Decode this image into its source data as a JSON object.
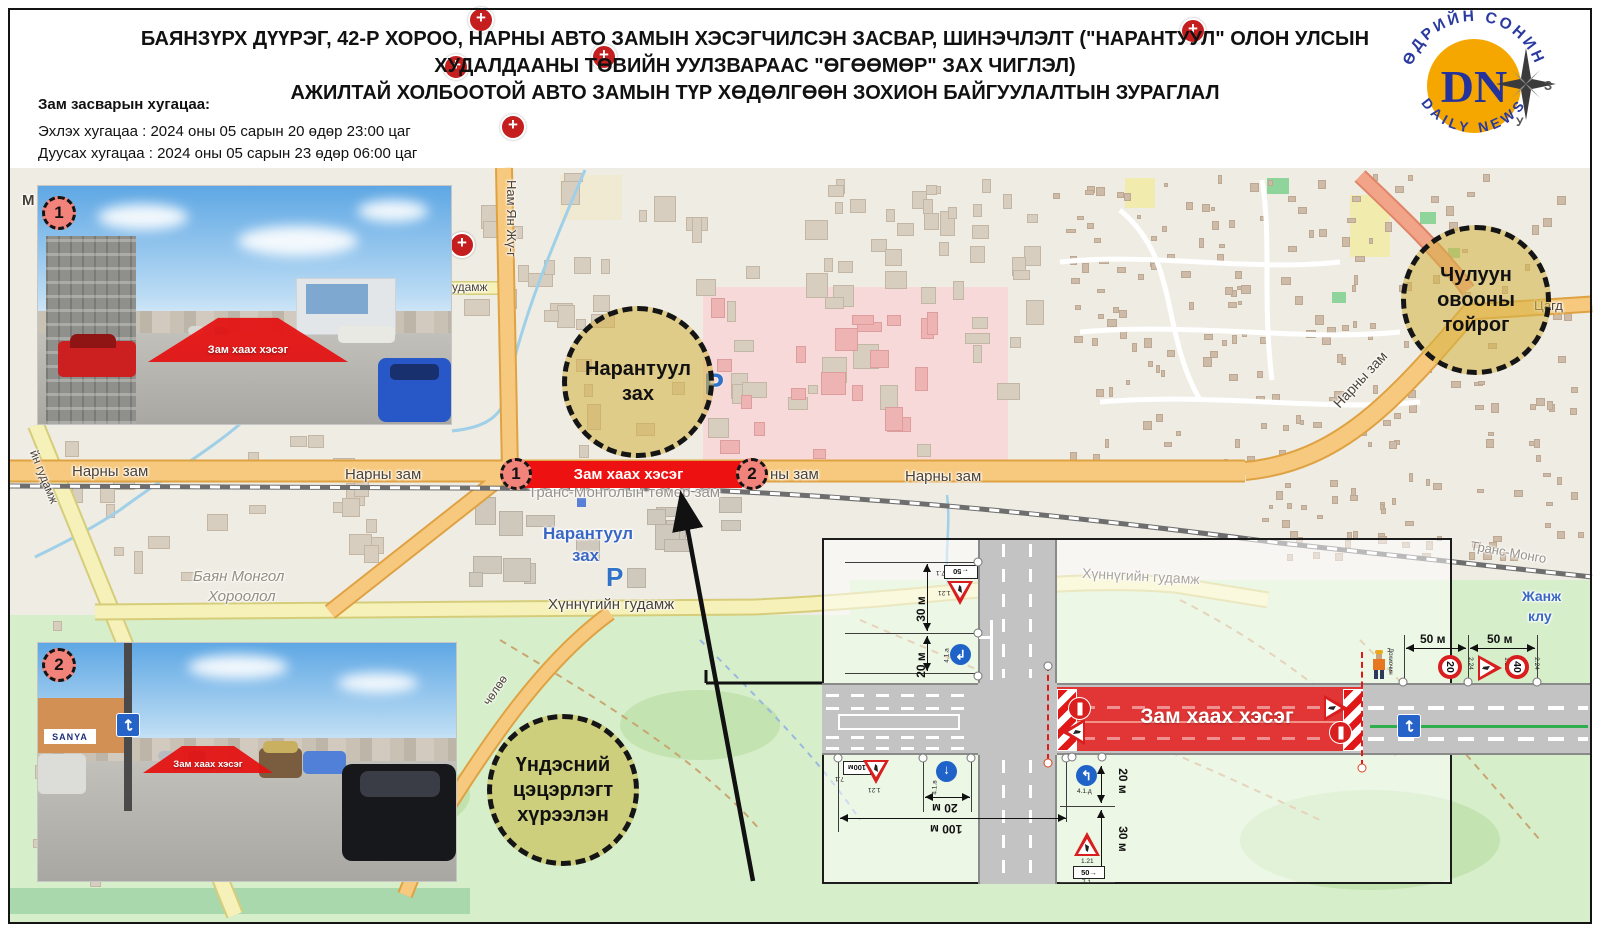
{
  "header": {
    "title_line1": "БАЯНЗҮРХ ДҮҮРЭГ, 42-Р ХОРОО, НАРНЫ АВТО ЗАМЫН ХЭСЭГЧИЛСЭН ЗАСВАР, ШИНЭЧЛЭЛТ (\"НАРАНТУУЛ\" ОЛОН УЛСЫН",
    "title_line2": "ХУДАЛДААНЫ ТӨВИЙН УУЛЗВАРААС \"ӨГӨӨМӨР\" ЗАХ ЧИГЛЭЛ)",
    "title_line3": "АЖИЛТАЙ ХОЛБООТОЙ АВТО ЗАМЫН ТҮР ХӨДӨЛГӨӨН ЗОХИОН БАЙГУУЛАЛТЫН ЗУРАГЛАЛ",
    "schedule_heading": "Зам засварын хугацаа:",
    "schedule_start": "Эхлэх хугацаа : 2024 оны 05 сарын 20 өдөр 23:00 цаг",
    "schedule_end": "Дуусах хугацаа : 2024 оны 05 сарын 23 өдөр 06:00 цаг"
  },
  "logo": {
    "initials": "DN",
    "ring_top": "ӨДРИЙН СОНИН",
    "ring_bottom": "DAILY NEWS",
    "compass_east": "З",
    "compass_south": "У",
    "disc_color": "#F5A700",
    "letters_color": "#23339B"
  },
  "map": {
    "closure_label": "Зам хаах хэсэг",
    "badge_1": "1",
    "badge_2": "2",
    "circles": {
      "narantuul_l1": "Нарантуул",
      "narantuul_l2": "зах",
      "chuluun_l1": "Чулуун",
      "chuluun_l2": "овооны",
      "chuluun_l3": "тойрог",
      "park_l1": "Үндэсний",
      "park_l2": "цэцэрлэгт",
      "park_l3": "хүрээлэн"
    },
    "roads": {
      "narny": "Нарны зам",
      "narny_fragment": "ны зам",
      "nam_yan": "Нам Ян Жү-г",
      "udamj": "удамж",
      "khunnu": "Хүннүгийн гудамж",
      "cholo": "чөлөө",
      "left_street": "йн гудамж",
      "tsagd": "Цагд",
      "railway": "Транс-Монголын төмөр зам",
      "railway_short": "Транс-Монго"
    },
    "labels": {
      "narantuul_l1": "Нарантуул",
      "narantuul_l2": "зах",
      "bayan_l1": "Баян Монгол",
      "bayan_l2": "Хороолол",
      "janj": "Жанж",
      "klub": "клу",
      "parking": "P",
      "m_fragment": "М"
    }
  },
  "photos": {
    "overlay": "Зам хаах хэсэг",
    "badge_1": "1",
    "badge_2": "2",
    "storefront": "SANYA"
  },
  "diagram": {
    "closure_label": "Зам хаах хэсэг",
    "dist_30": "30 м",
    "dist_20": "20 м",
    "dist_50": "50 м",
    "dist_100": "100 м",
    "speed_20": "20",
    "speed_40": "40",
    "plate_100": "100м",
    "plate_50": "50",
    "code_roadwork": "1.21",
    "code_plate": "7.1",
    "code_speed": "2.24",
    "code_blue_a": "4.1.а",
    "code_blue_b": "4.1.в",
    "code_blue_d": "4.1.д",
    "flagger": "Дохиочин"
  }
}
